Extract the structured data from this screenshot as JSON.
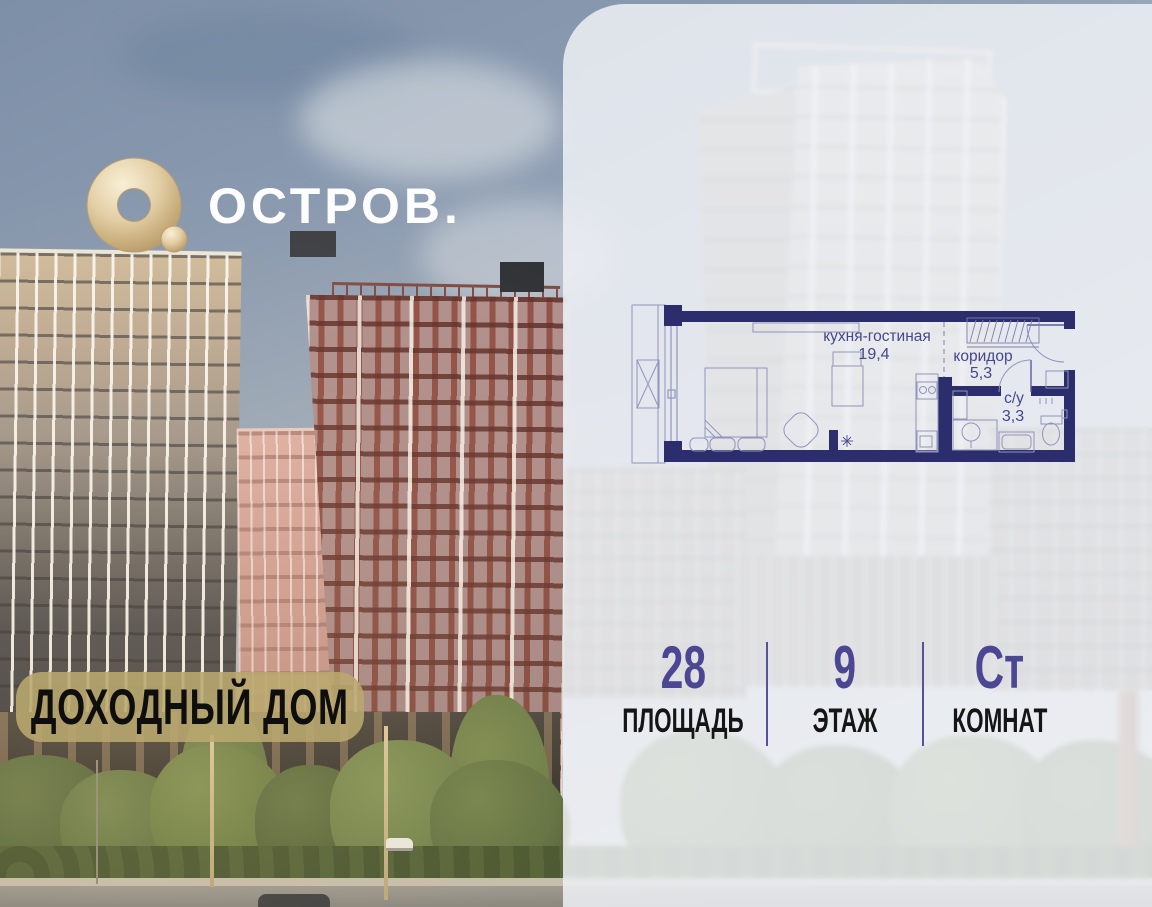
{
  "brand": {
    "logo_text": "ОСТРОВ.",
    "logo_icon": "gold-ring-logo-icon",
    "badge_label": "ДОХОДНЫЙ ДОМ"
  },
  "floor_plan": {
    "rooms": [
      {
        "name": "кухня-гостиная",
        "area": "19,4"
      },
      {
        "name": "коридор",
        "area": "5,3"
      },
      {
        "name": "с/у",
        "area": "3,3"
      }
    ]
  },
  "stats": {
    "items": [
      {
        "value": "28",
        "label": "ПЛОЩАДЬ"
      },
      {
        "value": "9",
        "label": "ЭТАЖ"
      },
      {
        "value": "Ст",
        "label": "КОМНАТ"
      }
    ]
  },
  "colors": {
    "plan_wall_navy": "#2b2d6c",
    "plan_text": "#44478c",
    "stat_value_purple": "#4c4792",
    "stat_label_black": "#151515",
    "badge_gold": "#b9a86e",
    "panel_frost": "#eef1f6",
    "logo_gold": "#d9c49a"
  }
}
